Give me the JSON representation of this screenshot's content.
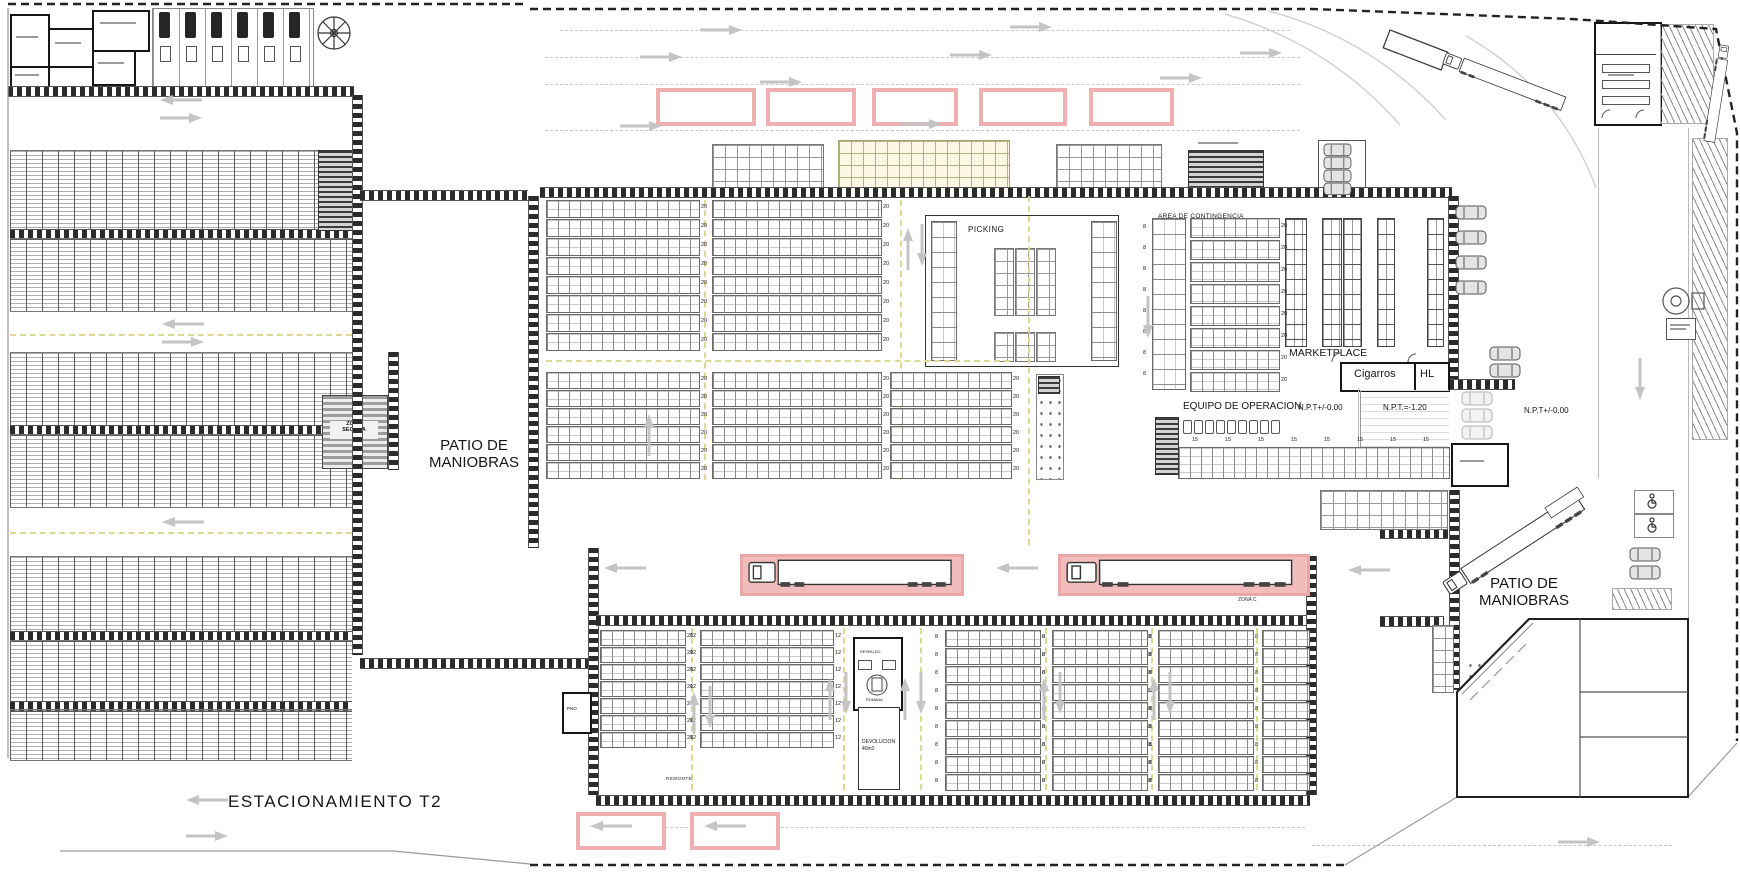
{
  "document": {
    "type": "architectural site plan",
    "subject": "warehouse distribution center layout"
  },
  "colors": {
    "highlight_pink": "#eeb0b0",
    "highlight_pink_fill": "#f2bcbc",
    "aisle_yellow_dash": "#ddd893",
    "road_gray": "#c4c4c4",
    "wall_dark": "#2b2b2b"
  },
  "labels": {
    "patio_maniobras_left": "PATIO DE MANIOBRAS",
    "patio_maniobras_right": "PATIO DE MANIOBRAS",
    "estacionamiento_t2": "ESTACIONAMIENTO T2",
    "zona_segura_line1": "ZONA",
    "zona_segura_line2": "SEGURA",
    "picking": "PICKING",
    "marketplace": "MARKETPLACE",
    "cigarros": "Cigarros",
    "hl": "HL",
    "area_contingencia": "AREA DE CONTINGENCIA",
    "equipo_operacion": "EQUIPO DE OPERACION",
    "npt_interior": "N.P.T+/-0.00",
    "npt_foso": "N.P.T.=-1.20",
    "npt_exterior": "N.P.T+/-0,00",
    "devolucion": "DEVOLUCION",
    "devolucion_area": "40m2",
    "remonte": "REMONTE",
    "respaldo": "RESPALDO",
    "romana": "ROMANA",
    "pno": "PNO",
    "zona_c": "ZONA C"
  },
  "rack_groups": [
    {
      "zone": "upper-left-a",
      "capacity": "20",
      "rows": 8
    },
    {
      "zone": "upper-left-b",
      "capacity": "20",
      "rows": 8
    },
    {
      "zone": "mid-a",
      "capacity": "20",
      "rows": 6
    },
    {
      "zone": "mid-b",
      "capacity": "20",
      "rows": 6
    },
    {
      "zone": "mid-c",
      "capacity": "20",
      "rows": 6
    },
    {
      "zone": "contingencia-flow-racks",
      "capacity": "20",
      "rows": 8
    },
    {
      "zone": "lower-a",
      "capacity": "20",
      "rows": 7
    },
    {
      "zone": "lower-b",
      "capacity": "12",
      "rows": 7
    },
    {
      "zone": "lower-c",
      "capacity": "8",
      "rows": 9
    },
    {
      "zone": "lower-d",
      "capacity": "8",
      "rows": 9
    },
    {
      "zone": "lower-e",
      "capacity": "8",
      "rows": 9
    },
    {
      "zone": "lower-f",
      "capacity": "",
      "rows": 9
    }
  ],
  "repeat_labels": {
    "equipo_bay": "15",
    "contingencia_cell": "8"
  }
}
